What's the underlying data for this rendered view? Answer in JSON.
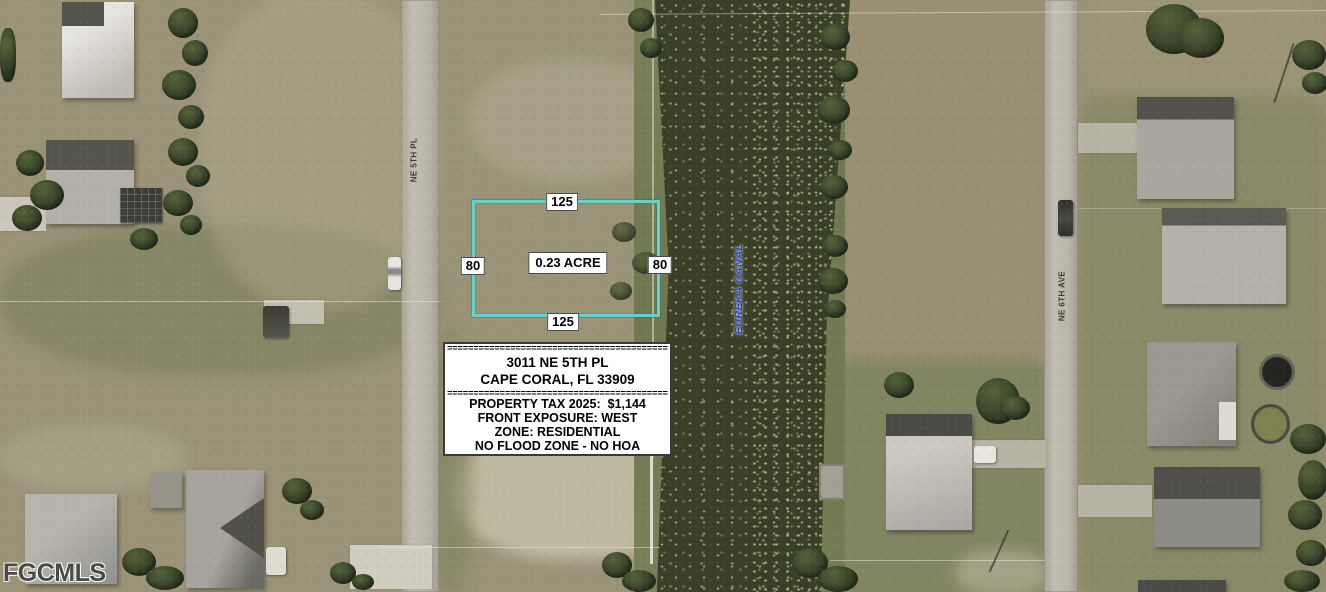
{
  "map": {
    "watermark": "FGCMLS",
    "canal": {
      "label": "EUREKA CANAL"
    },
    "streets": {
      "left": "NE 5TH PL",
      "right": "NE 6TH AVE"
    },
    "lot": {
      "area_label": "0.23 ACRE",
      "dim_top": "125",
      "dim_bottom": "125",
      "dim_left": "80",
      "dim_right": "80"
    },
    "info_box": {
      "separator": "==========================================",
      "address_line1": "3011 NE 5TH PL",
      "address_line2": "CAPE CORAL, FL 33909",
      "details": [
        "PROPERTY TAX 2025:  $1,144",
        "FRONT EXPOSURE: WEST",
        "ZONE: RESIDENTIAL",
        "NO FLOOD ZONE - NO HOA"
      ]
    },
    "colors": {
      "lot_outline": "#68d1ca",
      "canal_water": "#394027",
      "field": "#97906f",
      "lawn": "#878a63",
      "road": "#bcb8ab",
      "canal_label_blue": "#2d43d6"
    }
  }
}
